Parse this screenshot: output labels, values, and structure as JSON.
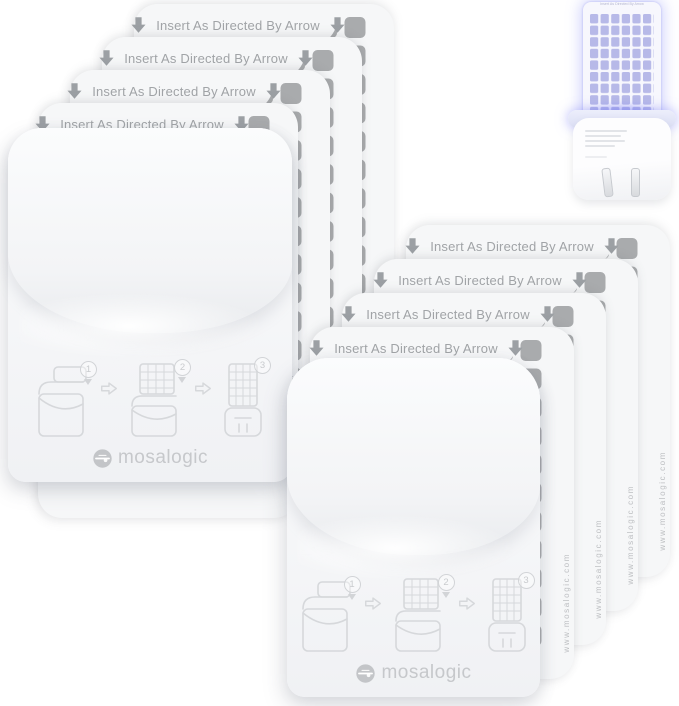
{
  "brand": {
    "name": "mosalogic"
  },
  "refill_card": {
    "header_text": "Insert As Directed By Arrow",
    "url_text": "www.mosalogic.com",
    "square_color": "#a9abad",
    "card_count": 8
  },
  "pouch": {
    "brand_label": "mosalogic",
    "steps": [
      {
        "number": "1"
      },
      {
        "number": "2"
      },
      {
        "number": "3"
      }
    ]
  },
  "device": {
    "card_header_text": "Insert As Directed By Arrow",
    "glow_color": "#7c80f6"
  }
}
